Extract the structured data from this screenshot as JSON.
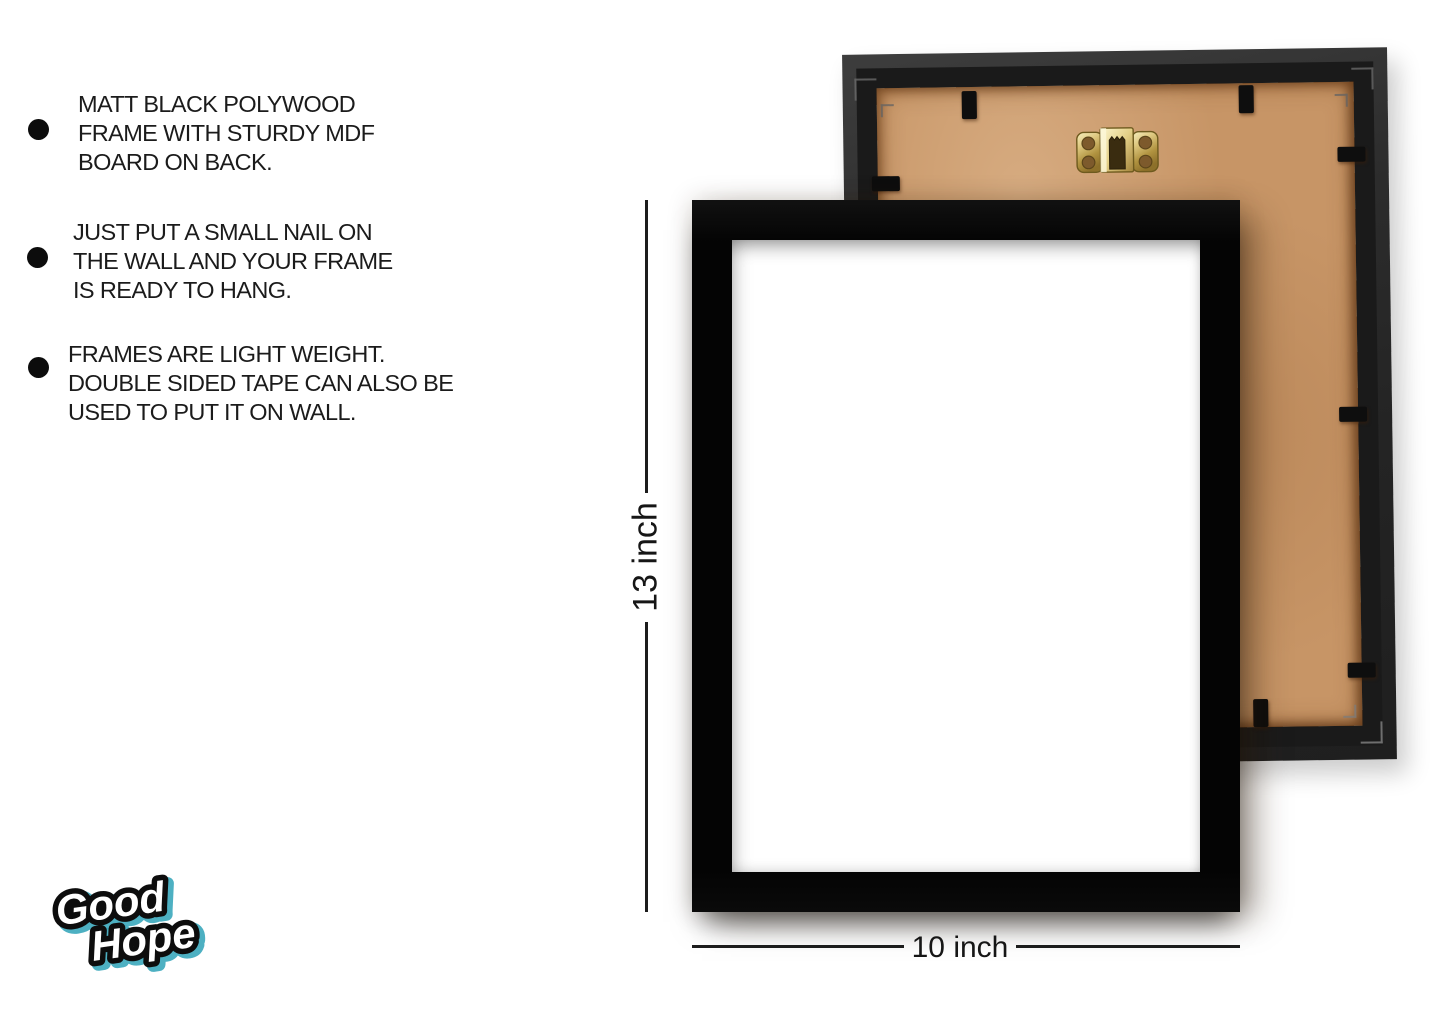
{
  "features": {
    "items": [
      {
        "lines": [
          "MATT BLACK POLYWOOD",
          "FRAME WITH STURDY MDF",
          "BOARD ON BACK."
        ]
      },
      {
        "lines": [
          "JUST PUT A SMALL NAIL ON",
          "THE WALL AND YOUR FRAME",
          "IS READY TO HANG."
        ]
      },
      {
        "lines": [
          "FRAMES ARE LIGHT WEIGHT.",
          "DOUBLE SIDED TAPE CAN ALSO BE",
          "USED TO PUT IT ON WALL."
        ]
      }
    ]
  },
  "dimensions": {
    "height_label": "13 inch",
    "width_label": "10 inch"
  },
  "logo": {
    "line1": "Good",
    "line2": "Hope",
    "accent_color": "#3aa8bc"
  },
  "product": {
    "front_frame": {
      "frame_color": "#040404",
      "opening_color": "#ffffff"
    },
    "back_frame": {
      "frame_color": "#2b2b2b",
      "board_color": "#c79566",
      "hanger_icon": "sawtooth-gold-hanger",
      "hanger_color": "#cdb569",
      "clip_color": "#0e0e0e"
    }
  }
}
